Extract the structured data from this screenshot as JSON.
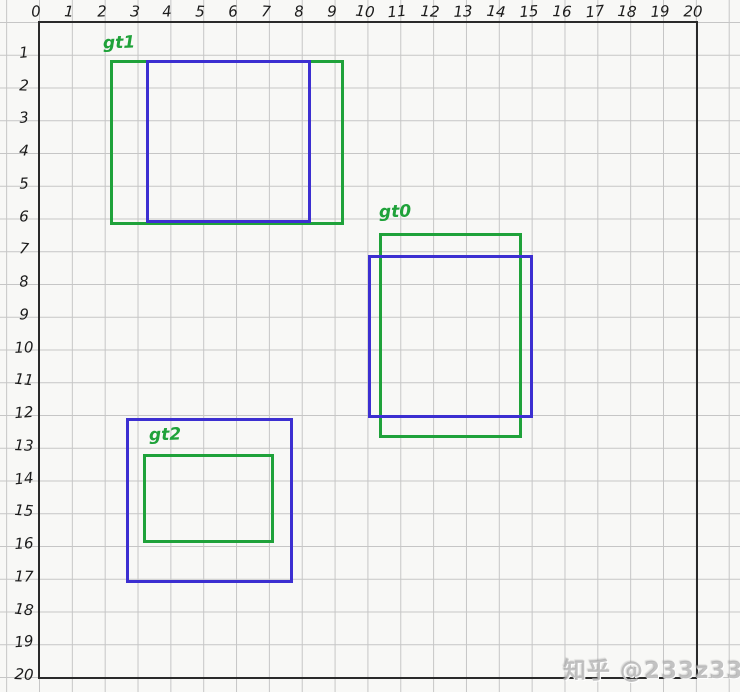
{
  "watermark": {
    "text": "知乎 @233z33"
  },
  "axes": {
    "x_ticks": [
      "0",
      "1",
      "2",
      "3",
      "4",
      "5",
      "6",
      "7",
      "8",
      "9",
      "10",
      "11",
      "12",
      "13",
      "14",
      "15",
      "16",
      "17",
      "18",
      "19",
      "20"
    ],
    "y_ticks": [
      "1",
      "2",
      "3",
      "4",
      "5",
      "6",
      "7",
      "8",
      "9",
      "10",
      "11",
      "12",
      "13",
      "14",
      "15",
      "16",
      "17",
      "18",
      "19",
      "20"
    ]
  },
  "colors": {
    "ground_truth_green": "#1fa23a",
    "prediction_blue": "#3c2fd1",
    "axis_ink": "#2a2a2a",
    "grid_line": "#c6c6c6",
    "paper": "#f8f8f6",
    "tick_ink": "#1c1c1c",
    "watermark_gray": "#adadad"
  },
  "figure": {
    "description": "Hand-drawn graph paper with ground-truth (green) and predicted (blue) bounding boxes",
    "grid": {
      "origin_x_px": 39,
      "origin_y_px": 22,
      "cell_w_px": 32.85,
      "cell_h_px": 32.75,
      "x_range": [
        0,
        20
      ],
      "y_range": [
        0,
        20
      ],
      "border_px": {
        "left": 39,
        "top": 22,
        "right": 696,
        "bottom": 677
      }
    },
    "boxes": [
      {
        "name": "gt1-green-box",
        "role": "ground-truth",
        "color": "#1fa23a",
        "x1": 2.2,
        "y1": 1.2,
        "x2": 9.25,
        "y2": 6.15
      },
      {
        "name": "pred1-blue-box",
        "role": "prediction",
        "color": "#3c2fd1",
        "x1": 3.3,
        "y1": 1.2,
        "x2": 8.25,
        "y2": 6.1
      },
      {
        "name": "gt0-green-box",
        "role": "ground-truth",
        "color": "#1fa23a",
        "x1": 10.4,
        "y1": 6.5,
        "x2": 14.65,
        "y2": 12.65
      },
      {
        "name": "pred0-blue-box",
        "role": "prediction",
        "color": "#3c2fd1",
        "x1": 10.05,
        "y1": 7.15,
        "x2": 15.0,
        "y2": 12.05
      },
      {
        "name": "gt2-green-box",
        "role": "ground-truth",
        "color": "#1fa23a",
        "x1": 3.2,
        "y1": 13.25,
        "x2": 7.1,
        "y2": 15.87
      },
      {
        "name": "pred2-blue-box",
        "role": "prediction",
        "color": "#3c2fd1",
        "x1": 2.7,
        "y1": 12.15,
        "x2": 7.7,
        "y2": 17.1
      }
    ],
    "labels": [
      {
        "name": "gt1-label",
        "text": "gt1",
        "x_px": 103,
        "y_px": 35,
        "color": "#1fa23a"
      },
      {
        "name": "gt0-label",
        "text": "gt0",
        "x_px": 379,
        "y_px": 204,
        "color": "#1fa23a"
      },
      {
        "name": "gt2-label",
        "text": "gt2",
        "x_px": 149,
        "y_px": 427,
        "color": "#1fa23a"
      }
    ]
  }
}
